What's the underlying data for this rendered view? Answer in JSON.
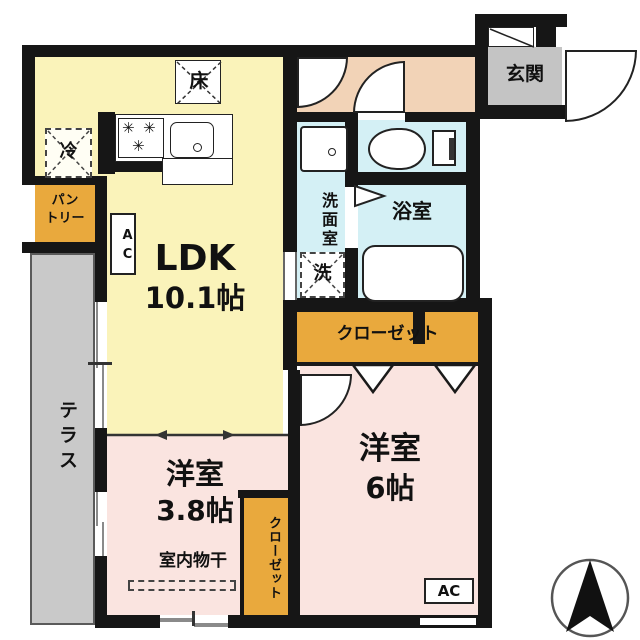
{
  "rooms": {
    "ldk": {
      "label": "LDK",
      "size": "10.1帖"
    },
    "bedroom_a": {
      "label": "洋室",
      "size": "3.8帖"
    },
    "bedroom_b": {
      "label": "洋室",
      "size": "6帖"
    },
    "entrance": {
      "label": "玄関"
    },
    "bath": {
      "label": "浴室"
    },
    "washroom": {
      "label": "洗面室"
    },
    "terrace": {
      "label": "テラス"
    },
    "pantry": {
      "line1": "パン",
      "line2": "トリー"
    },
    "closet_main": {
      "label": "クローゼット"
    },
    "closet_side": {
      "label": "クローゼット"
    }
  },
  "fixtures": {
    "floor_storage": "床",
    "refrigerator": "冷",
    "washer": "洗",
    "ac_ldk": "AC",
    "ac_room": "AC",
    "indoor_drying": "室内物干",
    "stove_burner_glyph": "✳"
  },
  "colors": {
    "wall": "#161616",
    "ldk": "#faf3ba",
    "bedroom": "#fae4e0",
    "wet": "#d4f0f5",
    "hall": "#f2d3b7",
    "entrance_floor": "#c4c4c4",
    "closet": "#e9a93d",
    "terrace": "#c9c9c9"
  }
}
